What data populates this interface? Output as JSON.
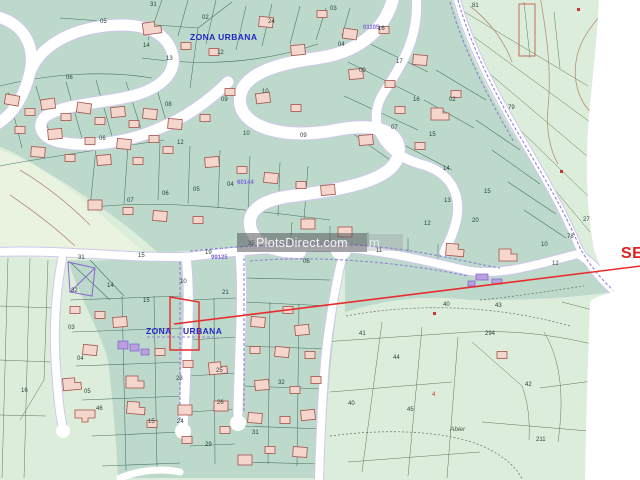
{
  "map": {
    "title": "Cadastral plan with urban zone parcels",
    "watermark": {
      "text": "PlotsDirect.com",
      "ghost": "m"
    },
    "annotation": {
      "label": "SE"
    },
    "labels": [
      {
        "t": "ZONA URBANA",
        "x": 190,
        "y": 33,
        "k": "zona"
      },
      {
        "t": "ZONA",
        "x": 146,
        "y": 327,
        "k": "zona"
      },
      {
        "t": "URBANA",
        "x": 183,
        "y": 327,
        "k": "zona"
      },
      {
        "t": "99125",
        "x": 211,
        "y": 255,
        "k": "code"
      },
      {
        "t": "01105",
        "x": 363,
        "y": 25,
        "k": "code"
      },
      {
        "t": "60144",
        "x": 237,
        "y": 180,
        "k": "code"
      },
      {
        "t": "Abier",
        "x": 450,
        "y": 427,
        "k": "abier"
      },
      {
        "t": "05",
        "x": 100,
        "y": 19,
        "k": "n"
      },
      {
        "t": "06",
        "x": 66,
        "y": 75,
        "k": "n"
      },
      {
        "t": "31",
        "x": 150,
        "y": 2,
        "k": "n"
      },
      {
        "t": "02",
        "x": 202,
        "y": 15,
        "k": "n"
      },
      {
        "t": "24",
        "x": 268,
        "y": 19,
        "k": "n"
      },
      {
        "t": "14",
        "x": 143,
        "y": 43,
        "k": "n"
      },
      {
        "t": "13",
        "x": 166,
        "y": 56,
        "k": "n"
      },
      {
        "t": "12",
        "x": 217,
        "y": 50,
        "k": "n"
      },
      {
        "t": "10",
        "x": 262,
        "y": 89,
        "k": "n"
      },
      {
        "t": "08",
        "x": 165,
        "y": 102,
        "k": "n"
      },
      {
        "t": "09",
        "x": 221,
        "y": 97,
        "k": "n"
      },
      {
        "t": "06",
        "x": 99,
        "y": 136,
        "k": "n"
      },
      {
        "t": "12",
        "x": 177,
        "y": 140,
        "k": "n"
      },
      {
        "t": "10",
        "x": 243,
        "y": 131,
        "k": "n"
      },
      {
        "t": "09",
        "x": 300,
        "y": 133,
        "k": "n"
      },
      {
        "t": "05",
        "x": 193,
        "y": 187,
        "k": "n"
      },
      {
        "t": "04",
        "x": 227,
        "y": 182,
        "k": "n"
      },
      {
        "t": "06",
        "x": 162,
        "y": 191,
        "k": "n"
      },
      {
        "t": "07",
        "x": 127,
        "y": 198,
        "k": "n"
      },
      {
        "t": "03",
        "x": 330,
        "y": 6,
        "k": "n"
      },
      {
        "t": "16",
        "x": 378,
        "y": 26,
        "k": "n"
      },
      {
        "t": "04",
        "x": 338,
        "y": 42,
        "k": "n"
      },
      {
        "t": "17",
        "x": 396,
        "y": 59,
        "k": "n"
      },
      {
        "t": "09",
        "x": 359,
        "y": 68,
        "k": "n"
      },
      {
        "t": "16",
        "x": 413,
        "y": 97,
        "k": "n"
      },
      {
        "t": "02",
        "x": 449,
        "y": 97,
        "k": "n"
      },
      {
        "t": "07",
        "x": 391,
        "y": 125,
        "k": "n"
      },
      {
        "t": "15",
        "x": 429,
        "y": 132,
        "k": "n"
      },
      {
        "t": "14",
        "x": 443,
        "y": 166,
        "k": "n"
      },
      {
        "t": "13",
        "x": 444,
        "y": 198,
        "k": "n"
      },
      {
        "t": "12",
        "x": 424,
        "y": 221,
        "k": "n"
      },
      {
        "t": "79",
        "x": 508,
        "y": 105,
        "k": "n"
      },
      {
        "t": "81",
        "x": 472,
        "y": 3,
        "k": "n"
      },
      {
        "t": "27",
        "x": 583,
        "y": 217,
        "k": "n"
      },
      {
        "t": "15",
        "x": 484,
        "y": 189,
        "k": "n"
      },
      {
        "t": "20",
        "x": 472,
        "y": 218,
        "k": "n"
      },
      {
        "t": "78",
        "x": 567,
        "y": 234,
        "k": "n"
      },
      {
        "t": "31",
        "x": 78,
        "y": 255,
        "k": "n"
      },
      {
        "t": "15",
        "x": 138,
        "y": 253,
        "k": "n"
      },
      {
        "t": "19",
        "x": 205,
        "y": 250,
        "k": "n"
      },
      {
        "t": "35",
        "x": 248,
        "y": 241,
        "k": "n"
      },
      {
        "t": "06",
        "x": 303,
        "y": 259,
        "k": "n"
      },
      {
        "t": "32",
        "x": 71,
        "y": 288,
        "k": "n"
      },
      {
        "t": "14",
        "x": 107,
        "y": 283,
        "k": "n"
      },
      {
        "t": "10",
        "x": 180,
        "y": 279,
        "k": "n"
      },
      {
        "t": "15",
        "x": 143,
        "y": 298,
        "k": "n"
      },
      {
        "t": "21",
        "x": 222,
        "y": 290,
        "k": "n"
      },
      {
        "t": "03",
        "x": 68,
        "y": 325,
        "k": "n"
      },
      {
        "t": "04",
        "x": 77,
        "y": 356,
        "k": "n"
      },
      {
        "t": "05",
        "x": 84,
        "y": 389,
        "k": "n"
      },
      {
        "t": "46",
        "x": 96,
        "y": 406,
        "k": "n"
      },
      {
        "t": "15",
        "x": 148,
        "y": 419,
        "k": "n"
      },
      {
        "t": "23",
        "x": 176,
        "y": 376,
        "k": "n"
      },
      {
        "t": "24",
        "x": 177,
        "y": 419,
        "k": "n"
      },
      {
        "t": "25",
        "x": 216,
        "y": 368,
        "k": "n"
      },
      {
        "t": "26",
        "x": 217,
        "y": 400,
        "k": "n"
      },
      {
        "t": "29",
        "x": 205,
        "y": 442,
        "k": "n"
      },
      {
        "t": "31",
        "x": 252,
        "y": 430,
        "k": "n"
      },
      {
        "t": "32",
        "x": 278,
        "y": 380,
        "k": "n"
      },
      {
        "t": "16",
        "x": 21,
        "y": 388,
        "k": "n"
      },
      {
        "t": "11",
        "x": 376,
        "y": 248,
        "k": "n"
      },
      {
        "t": "10",
        "x": 541,
        "y": 242,
        "k": "n"
      },
      {
        "t": "12",
        "x": 552,
        "y": 261,
        "k": "n"
      },
      {
        "t": "40",
        "x": 443,
        "y": 302,
        "k": "n"
      },
      {
        "t": "43",
        "x": 495,
        "y": 303,
        "k": "n"
      },
      {
        "t": "41",
        "x": 359,
        "y": 331,
        "k": "n"
      },
      {
        "t": "294",
        "x": 485,
        "y": 331,
        "k": "n"
      },
      {
        "t": "44",
        "x": 393,
        "y": 355,
        "k": "n"
      },
      {
        "t": "42",
        "x": 525,
        "y": 382,
        "k": "n"
      },
      {
        "t": "40",
        "x": 348,
        "y": 401,
        "k": "n"
      },
      {
        "t": "45",
        "x": 407,
        "y": 407,
        "k": "n"
      },
      {
        "t": "211",
        "x": 536,
        "y": 437,
        "k": "n"
      },
      {
        "t": "4",
        "x": 432,
        "y": 392,
        "k": "red"
      }
    ],
    "colors": {
      "urban_fill": "#bcd9cb",
      "rural_fill": "#ddeddb",
      "road": "#ffffff",
      "road_edge": "#cfc8ec",
      "building_fill": "#f5d6cd",
      "building_stroke": "#a5524a",
      "parcel_line": "#4a7263",
      "zona_text": "#2626c4",
      "street_code": "#7b68d8",
      "annotation_red": "#e82c2c",
      "watermark_bg": "rgba(88,88,95,0.55)"
    }
  }
}
